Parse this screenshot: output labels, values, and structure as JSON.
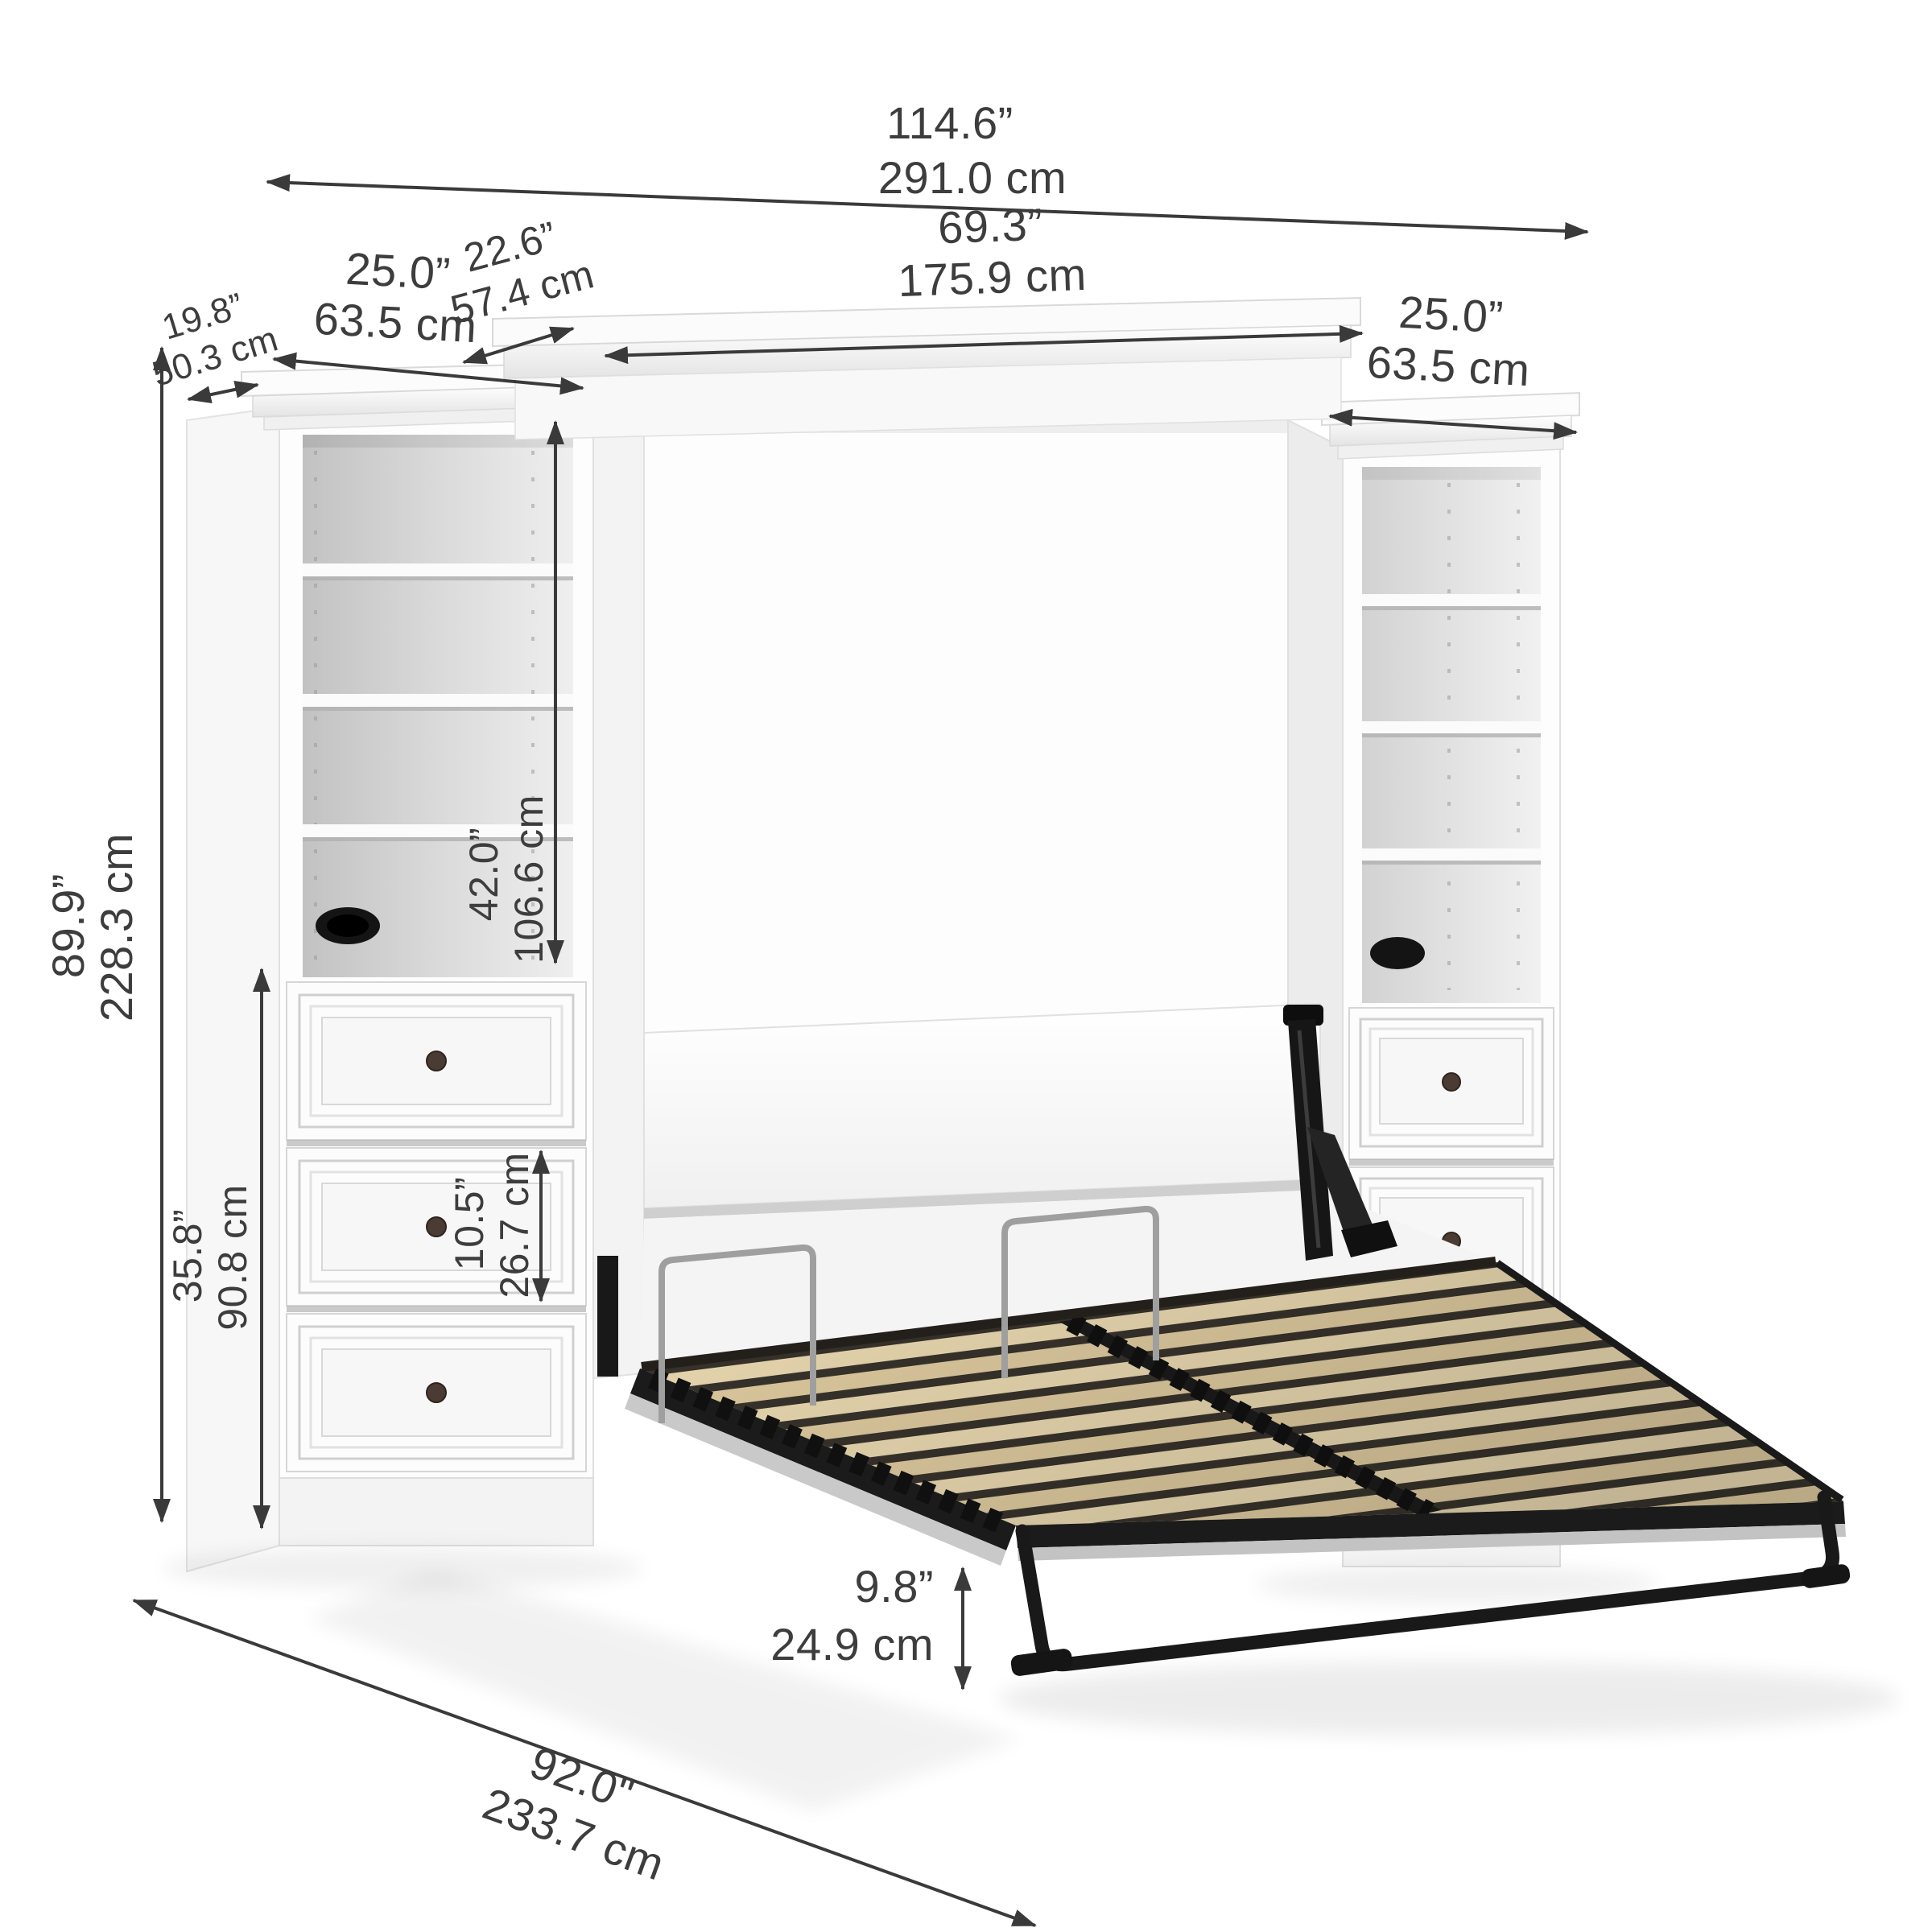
{
  "figure": {
    "kind": "product dimension diagram",
    "subject": "murphy wall bed (open) with two storage towers, white finish",
    "background": "#ffffff"
  },
  "palette": {
    "dimension_text": "#3d3d3d",
    "dimension_line": "#3a3a3a",
    "furniture_white": "#fdfdfd",
    "interior_gray": "#c9c9c9",
    "frame_black": "#1a1a1a",
    "slat_wood": "#e8d7af",
    "slat_wood_alt": "#ddc99e",
    "chrome": "#9f9f9f",
    "knob_bronze": "#4a3c33"
  },
  "dimensions": {
    "overall_width": {
      "inches": "114.6”",
      "metric": "291.0 cm"
    },
    "center_crown_depth": {
      "inches": "22.6”",
      "metric": "57.4 cm"
    },
    "bed_section_width": {
      "inches": "69.3”",
      "metric": "175.9 cm"
    },
    "left_tower_width": {
      "inches": "25.0”",
      "metric": "63.5 cm"
    },
    "tower_depth": {
      "inches": "19.8”",
      "metric": "50.3 cm"
    },
    "right_tower_width": {
      "inches": "25.0”",
      "metric": "63.5 cm"
    },
    "overall_height": {
      "inches": "89.9”",
      "metric": "228.3 cm"
    },
    "open_shelf_section_height": {
      "inches": "42.0”",
      "metric": "106.6 cm"
    },
    "drawer_section_height": {
      "inches": "35.8”",
      "metric": "90.8 cm"
    },
    "drawer_height": {
      "inches": "10.5”",
      "metric": "26.7 cm"
    },
    "under_bed_clearance": {
      "inches": "9.8”",
      "metric": "24.9 cm"
    },
    "depth_with_bed_open": {
      "inches": "92.0\"",
      "metric": "233.7 cm"
    }
  },
  "parts": {
    "left_tower": {
      "open_compartments": 4,
      "shelves": 3,
      "drawers": 3,
      "wire_grommet": true
    },
    "right_tower": {
      "open_compartments": 4,
      "shelves": 3,
      "drawers": 3,
      "wire_grommet": true
    },
    "bed": {
      "state": "open",
      "slat_sections": 2,
      "mattress_retainer_bars": 2,
      "lift_mechanism": true,
      "foot_support_bar": true
    }
  }
}
